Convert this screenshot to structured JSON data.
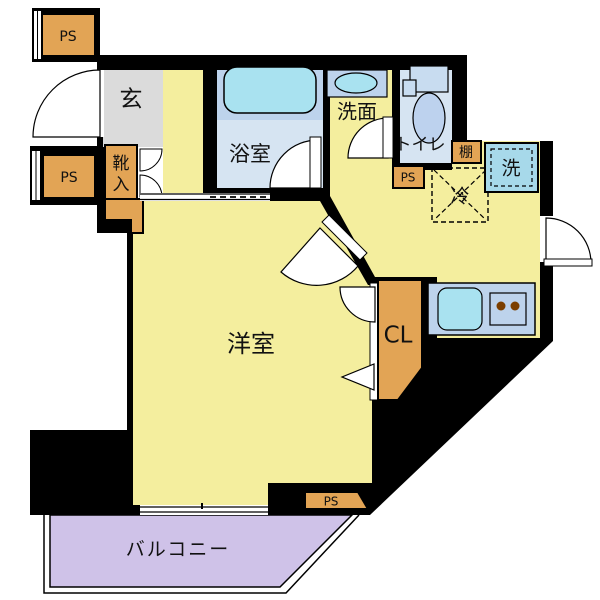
{
  "plan": {
    "type": "japanese-apartment-floor-plan",
    "labels": {
      "genkan": "玄",
      "bathroom": "浴室",
      "washroom": "洗面",
      "toilet": "トイレ",
      "shelf": "棚",
      "washer": "洗",
      "fridge": "冷",
      "western_room": "洋室",
      "closet": "CL",
      "balcony": "バルコニー",
      "shoe_char1": "靴",
      "shoe_char2": "入"
    },
    "ps_labels": {
      "top_left": "PS",
      "mid_left": "PS",
      "near_toilet": "PS",
      "bottom": "PS"
    },
    "colors": {
      "room_yellow": "#F4EE9E",
      "genkan_gray": "#DBDBDB",
      "service_orange": "#E2A455",
      "floor_blue_light": "#D6E4F2",
      "fixture_blue_mid": "#BDD3EC",
      "water_cyan": "#A9E2F0",
      "washer_blue": "#A7D9EA",
      "balcony_purple": "#CFC2E8",
      "wall_black": "#000000",
      "burner_brown": "#7B3F00"
    }
  }
}
